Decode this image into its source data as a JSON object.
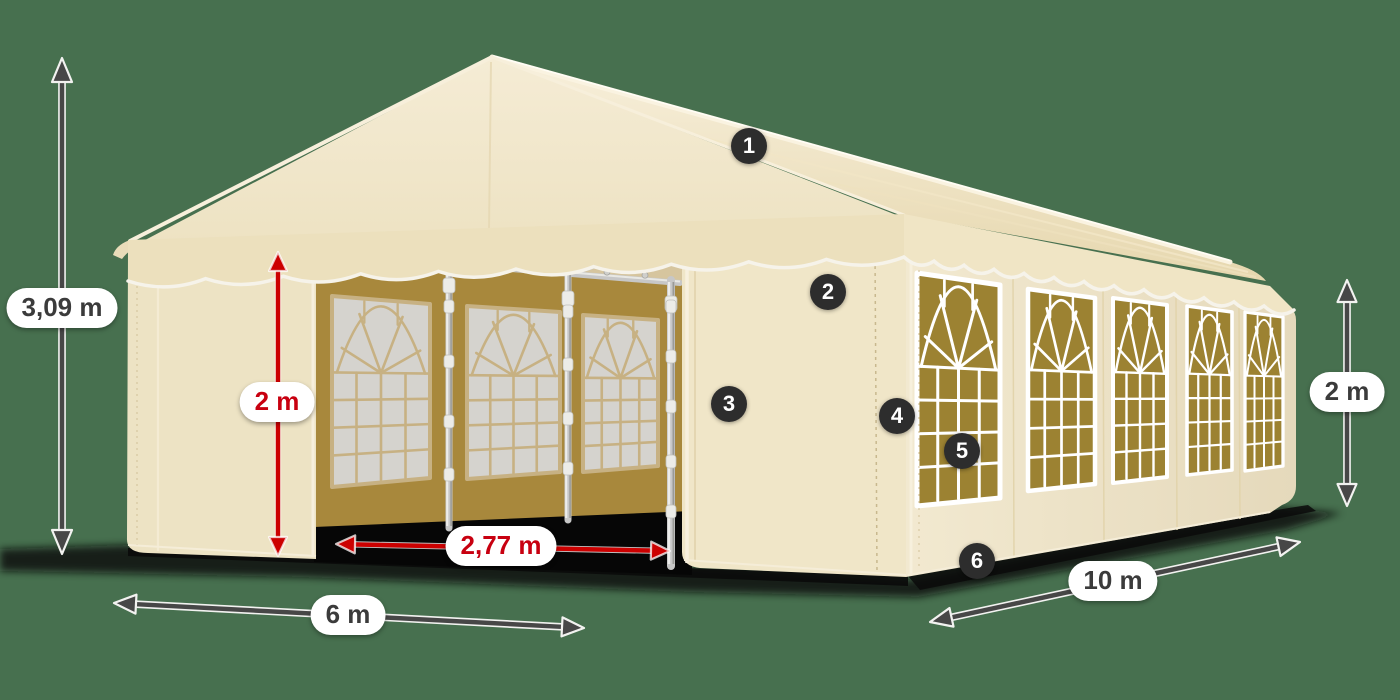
{
  "scene": {
    "description": "Beige PVC party tent 6 x 10 m with arched window side walls, open front entrance, shown in perspective on a green background with dimension arrows and numbered part callouts",
    "background_color": "#47704F"
  },
  "colors": {
    "fabric_cream": "#F0E6C9",
    "fabric_highlight": "#F8F0DC",
    "fabric_shadow": "#E6D7AE",
    "window_tint_khaki": "#9C8232",
    "interior_wall_khaki": "#A8883C",
    "interior_pane_gray": "#D5D3CE",
    "interior_mullion_tan": "#C7B183",
    "piping_white": "#F6F3EA",
    "pole_silver": "#C7C7C7",
    "dimension_dark": "#474747",
    "dimension_red": "#CC0000",
    "label_text_dark": "#3B3B3B",
    "label_text_red": "#C80010",
    "badge_background": "#2D2D2D",
    "badge_text": "#FFFFFF",
    "shadow_black": "#0A0A0A"
  },
  "dimensions": {
    "total_height": "3,09 m",
    "entrance_height": "2 m",
    "entrance_width": "2,77 m",
    "front_width": "6 m",
    "side_length": "10 m",
    "side_wall_height": "2 m"
  },
  "callouts": [
    "1",
    "2",
    "3",
    "4",
    "5",
    "6"
  ]
}
